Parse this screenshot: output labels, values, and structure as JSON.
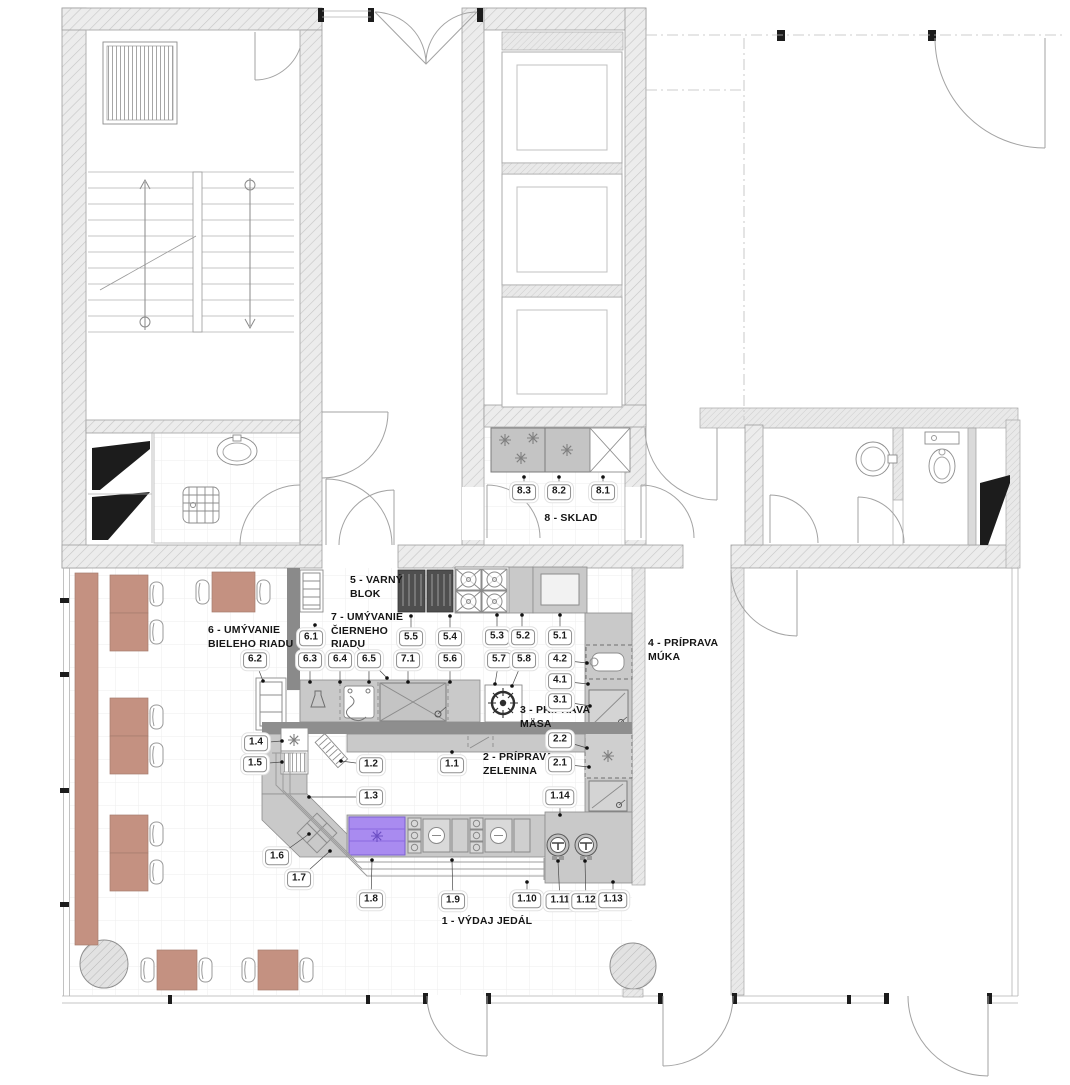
{
  "rooms": {
    "vydaj": "1 - VÝDAJ JEDÁL",
    "zelenina": "2 - PRÍPRAVA\nZELENINA",
    "maso": "3 - PRÍPRAVA\nMÄSA",
    "muka": "4 - PRÍPRAVA\nMÚKA",
    "varny": "5 - VARNÝ\nBLOK",
    "biele": "6 - UMÝVANIE\nBIELEHO RIADU",
    "cierne": "7 - UMÝVANIE\nČIERNEHO\nRIADU",
    "sklad": "8 - SKLAD"
  },
  "chips": {
    "c1_1": "1.1",
    "c1_2": "1.2",
    "c1_3": "1.3",
    "c1_4": "1.4",
    "c1_5": "1.5",
    "c1_6": "1.6",
    "c1_7": "1.7",
    "c1_8": "1.8",
    "c1_9": "1.9",
    "c1_10": "1.10",
    "c1_11": "1.11",
    "c1_12": "1.12",
    "c1_13": "1.13",
    "c1_14": "1.14",
    "c2_1": "2.1",
    "c2_2": "2.2",
    "c3_1": "3.1",
    "c4_1": "4.1",
    "c4_2": "4.2",
    "c5_1": "5.1",
    "c5_2": "5.2",
    "c5_3": "5.3",
    "c5_4": "5.4",
    "c5_5": "5.5",
    "c5_6": "5.6",
    "c5_7": "5.7",
    "c5_8": "5.8",
    "c6_1": "6.1",
    "c6_2": "6.2",
    "c6_3": "6.3",
    "c6_4": "6.4",
    "c6_5": "6.5",
    "c7_1": "7.1",
    "c8_1": "8.1",
    "c8_2": "8.2",
    "c8_3": "8.3"
  },
  "colors": {
    "accent_purple": "#a98bf0",
    "furniture_brown": "#c49181",
    "equipment_gray": "#c9c9c9"
  }
}
